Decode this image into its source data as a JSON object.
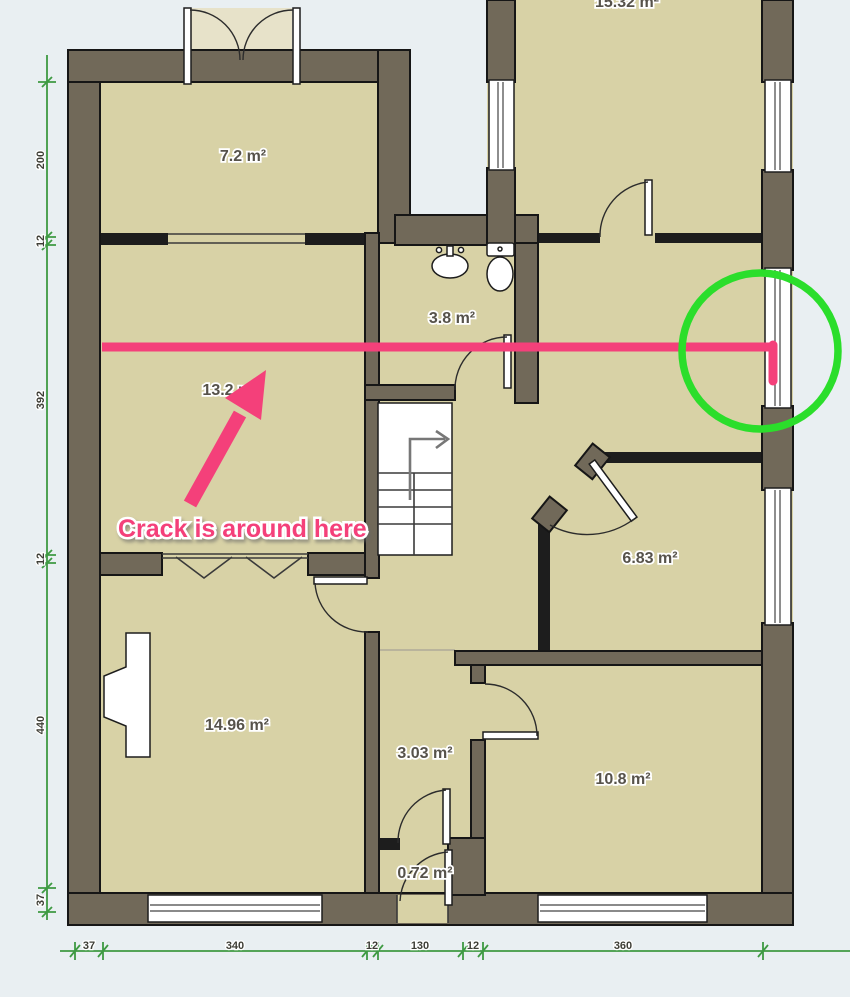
{
  "plan": {
    "rooms": [
      {
        "label": "7.2 m²"
      },
      {
        "label": "15.32 m²"
      },
      {
        "label": "13.2 m²"
      },
      {
        "label": "3.8 m²"
      },
      {
        "label": "6.83 m²"
      },
      {
        "label": "14.96 m²"
      },
      {
        "label": "3.03 m²"
      },
      {
        "label": "10.8 m²"
      },
      {
        "label": "0.72 m²"
      }
    ],
    "dimensions_left": [
      "200",
      "12",
      "392",
      "12",
      "440",
      "37"
    ],
    "dimensions_bottom": [
      "37",
      "340",
      "12",
      "130",
      "12",
      "360"
    ],
    "colors": {
      "floor": "#d8d2a6",
      "wall": "#716959",
      "dimension_green": "#3e9a42",
      "background": "#e9eff2"
    }
  },
  "annotations": {
    "crack_label": "Crack is around here",
    "pink": "#f4407a",
    "circle_green": "#2bde2b"
  }
}
